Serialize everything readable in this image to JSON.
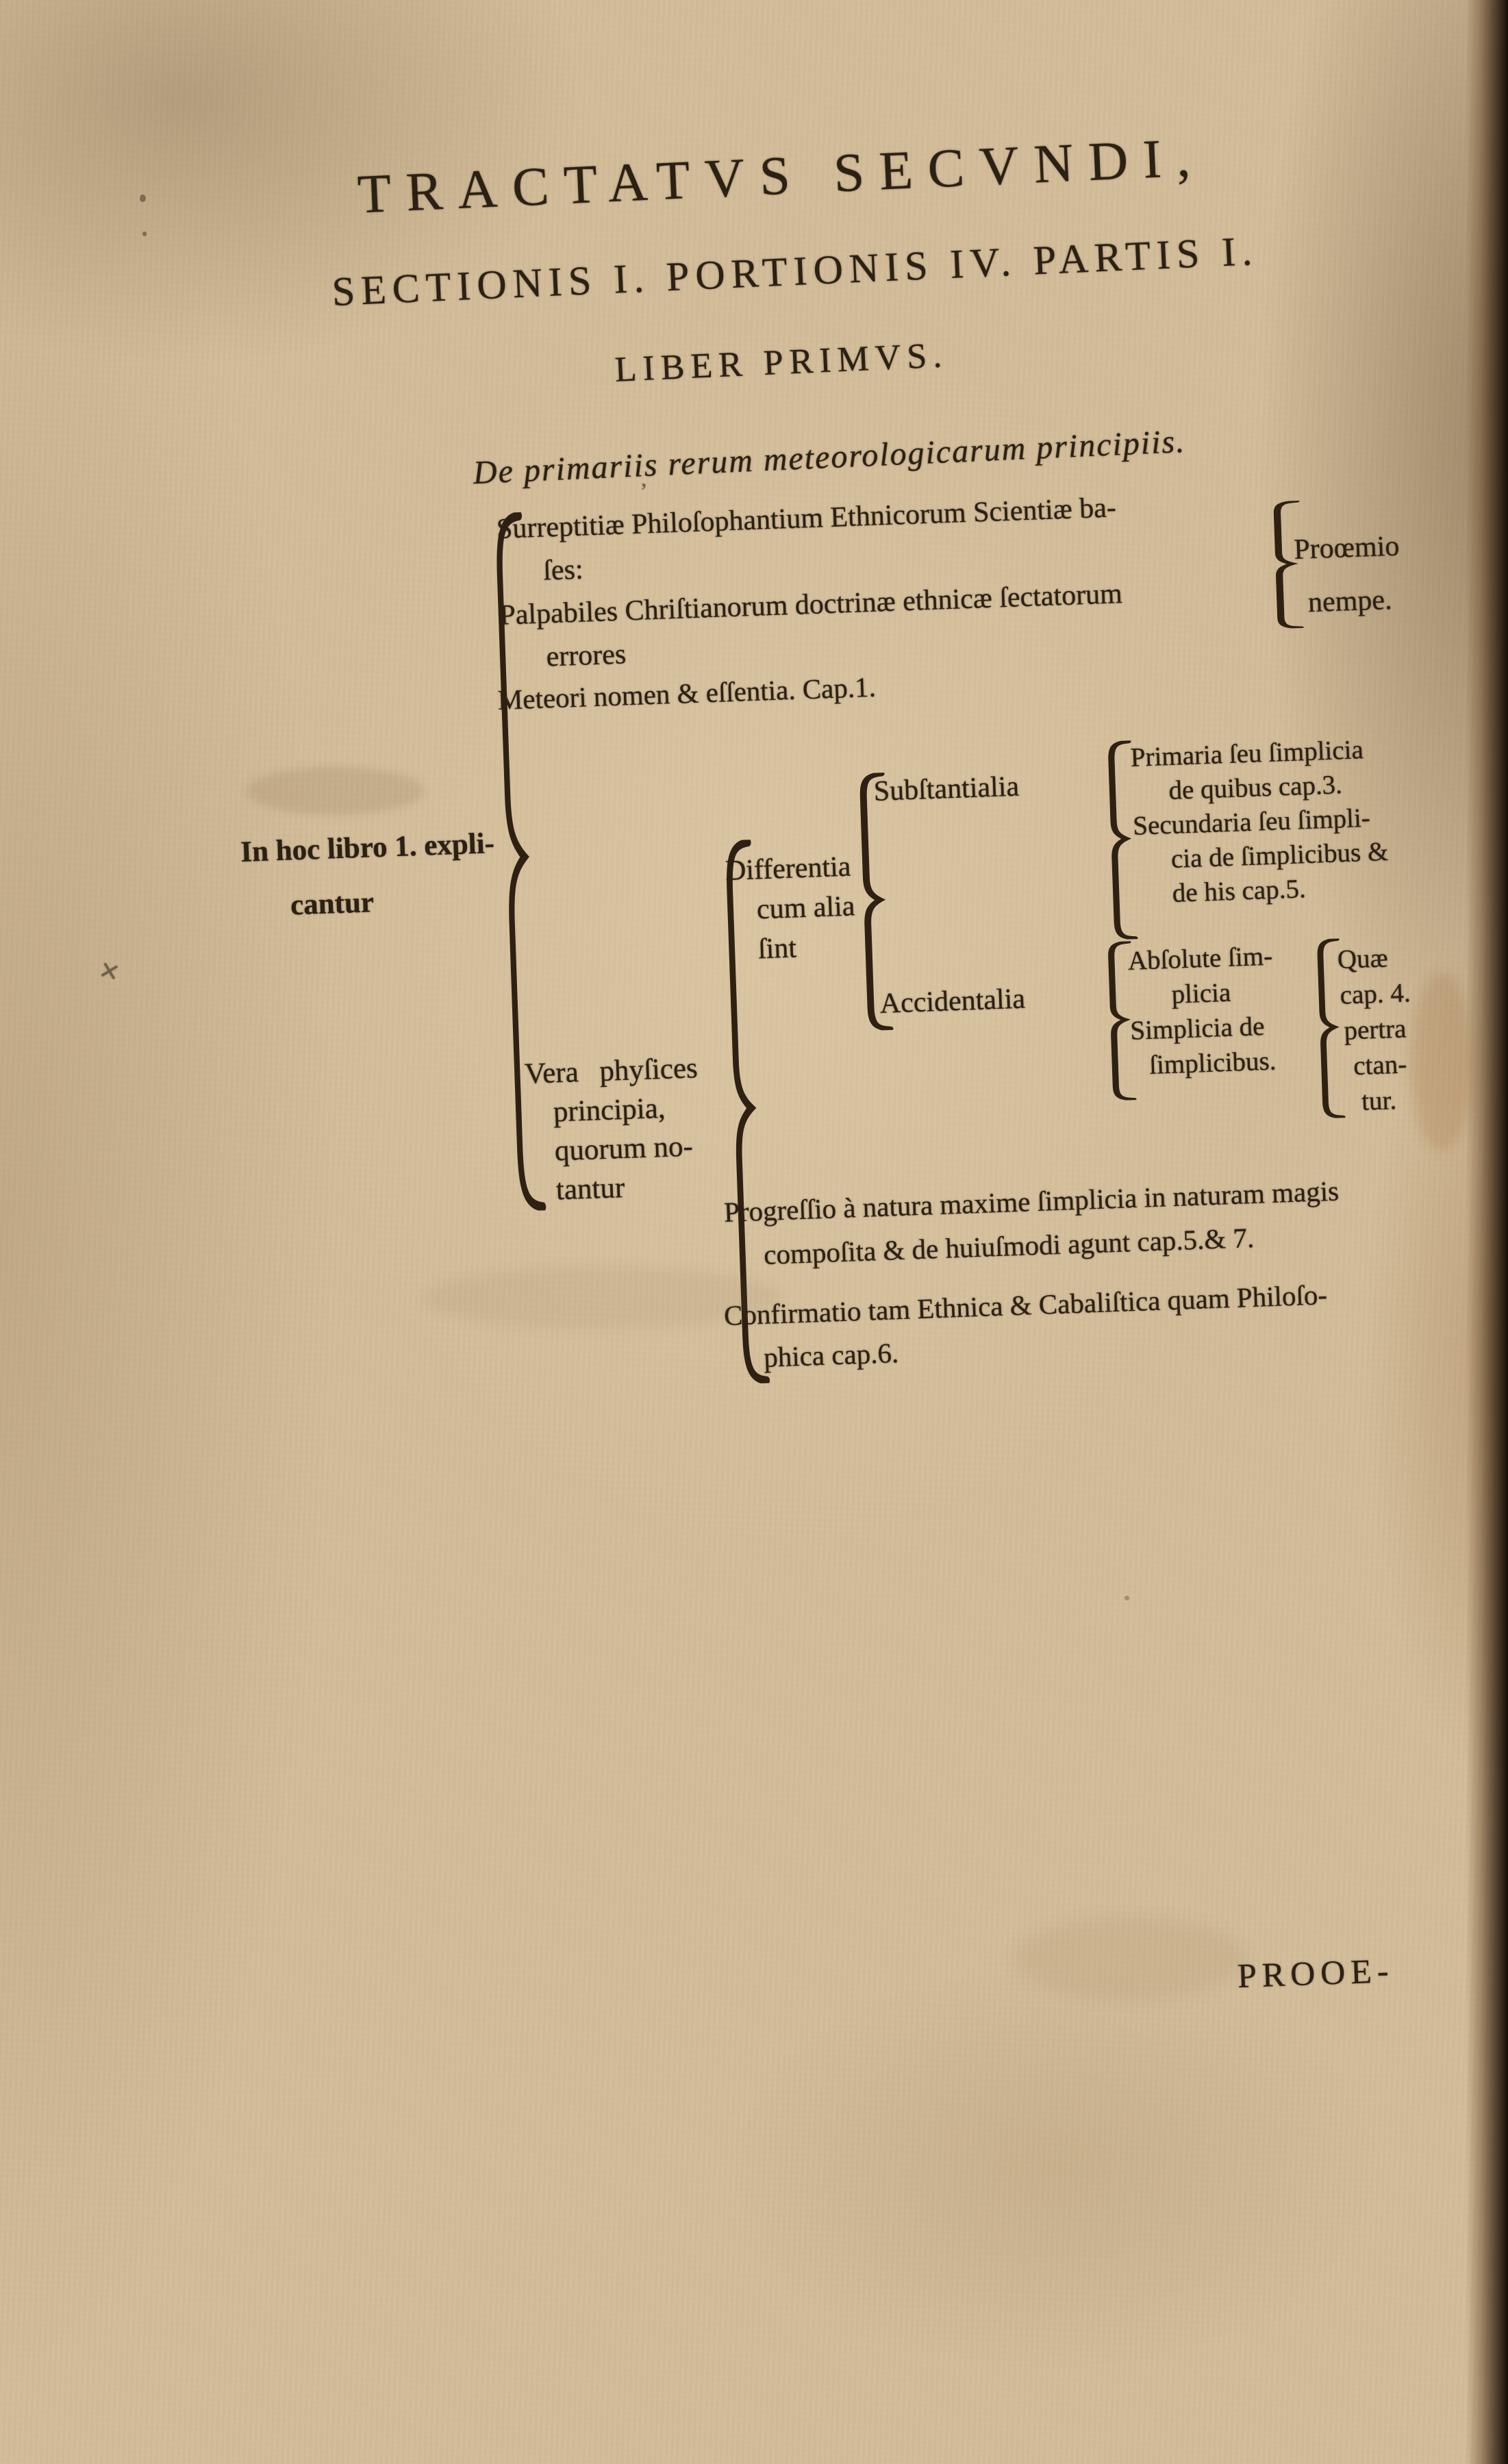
{
  "heading": {
    "line1": "TRACTATVS SECVNDI,",
    "line2": "SECTIONIS I. PORTIONIS IV. PARTIS I.",
    "line3": "LIBER PRIMVS.",
    "subtitle": "De primariis rerum meteorologicarum principiis."
  },
  "tree": {
    "root_label": {
      "line1": "In hoc libro 1. expli-",
      "line2": "cantur"
    },
    "errores": {
      "line1": "Surreptitiæ Philoſophantium Ethnicorum Scientiæ ba-",
      "line2": "ſes:",
      "line3": "Palpabiles Chriſtianorum doctrinæ ethnicæ ſectatorum",
      "line4": "errores",
      "result_line1": "Proœmio",
      "result_line2": "nempe."
    },
    "meteori": {
      "label": "Meteori nomen & eſſentia. Cap.1."
    },
    "principia": {
      "line1": "Vera phyſices",
      "line2": "principia,",
      "line3": "quorum no-",
      "line4": "tantur",
      "differentia": {
        "line1": "Differentia",
        "line2": "cum alia",
        "line3": "ſint"
      },
      "substantialia": {
        "label": "Subſtantialia"
      },
      "substantialia_kinds": {
        "line1": "Primaria ſeu ſimplicia",
        "line2": "de quibus cap.3.",
        "line3": "Secundaria ſeu ſimpli-",
        "line4": "cia de ſimplicibus &",
        "line5": "de his cap.5."
      },
      "accidentalia": {
        "label": "Accidentalia"
      },
      "accidentalia_kinds": {
        "line1": "Abſolute ſim-",
        "line2": "plicia",
        "line3": "Simplicia de",
        "line4": "ſimplicibus."
      },
      "accidentalia_note": {
        "line1": "Quæ",
        "line2": "cap. 4.",
        "line3": "pertra",
        "line4": "ctan-",
        "line5": "tur."
      },
      "progressio": {
        "line1": "Progreſſio à natura maxime ſimplicia in naturam magis",
        "line2": "compoſita & de huiuſmodi agunt cap.5.& 7."
      },
      "confirmatio": {
        "line1": "Confirmatio tam Ethnica & Cabaliſtica quam Philoſo-",
        "line2": "phica cap.6."
      }
    }
  },
  "catchword": "PROOE-",
  "colors": {
    "paper": "#d2bc99",
    "ink": "#2b2014",
    "page_edge": "#170e06"
  }
}
